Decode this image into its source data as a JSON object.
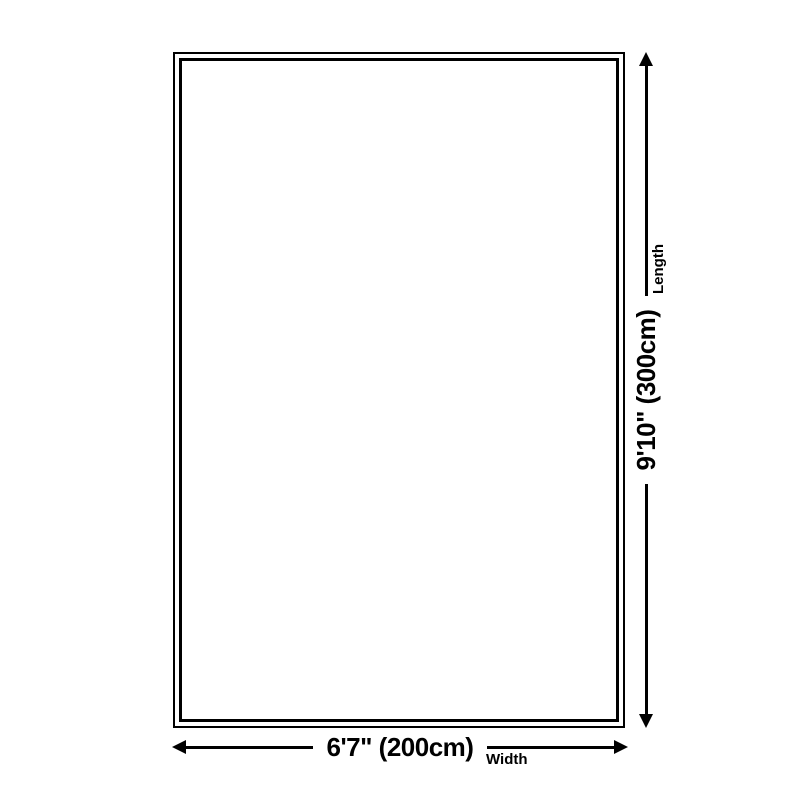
{
  "page": {
    "background_color": "#ffffff",
    "line_color": "#000000"
  },
  "diagram": {
    "length_arrow": {
      "dimension_label": "9'10\" (300cm)",
      "axis_label": "Length"
    },
    "width_arrow": {
      "dimension_label": "6'7\" (200cm)",
      "axis_label": "Width"
    }
  }
}
